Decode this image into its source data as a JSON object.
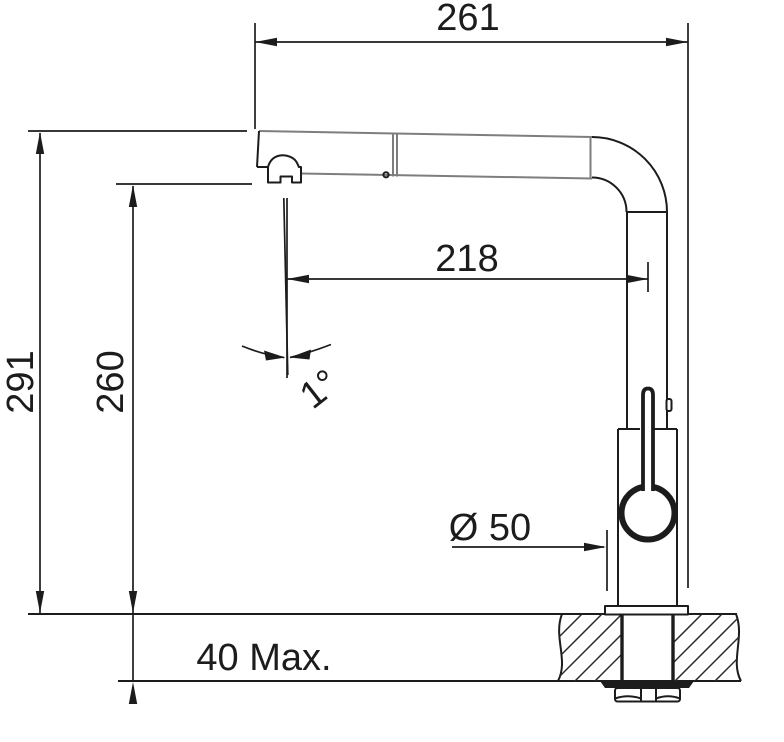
{
  "page": {
    "background": "#ffffff",
    "line_color": "#1c1c1c",
    "spout_line_color": "#7e7e7e"
  },
  "drawing": {
    "dimensions": {
      "overall_reach": "261",
      "outlet_reach": "218",
      "overall_height": "291",
      "outlet_height": "260",
      "spout_angle": "1°",
      "base_diameter": "Ø 50",
      "max_counter_thickness": "40 Max."
    }
  }
}
